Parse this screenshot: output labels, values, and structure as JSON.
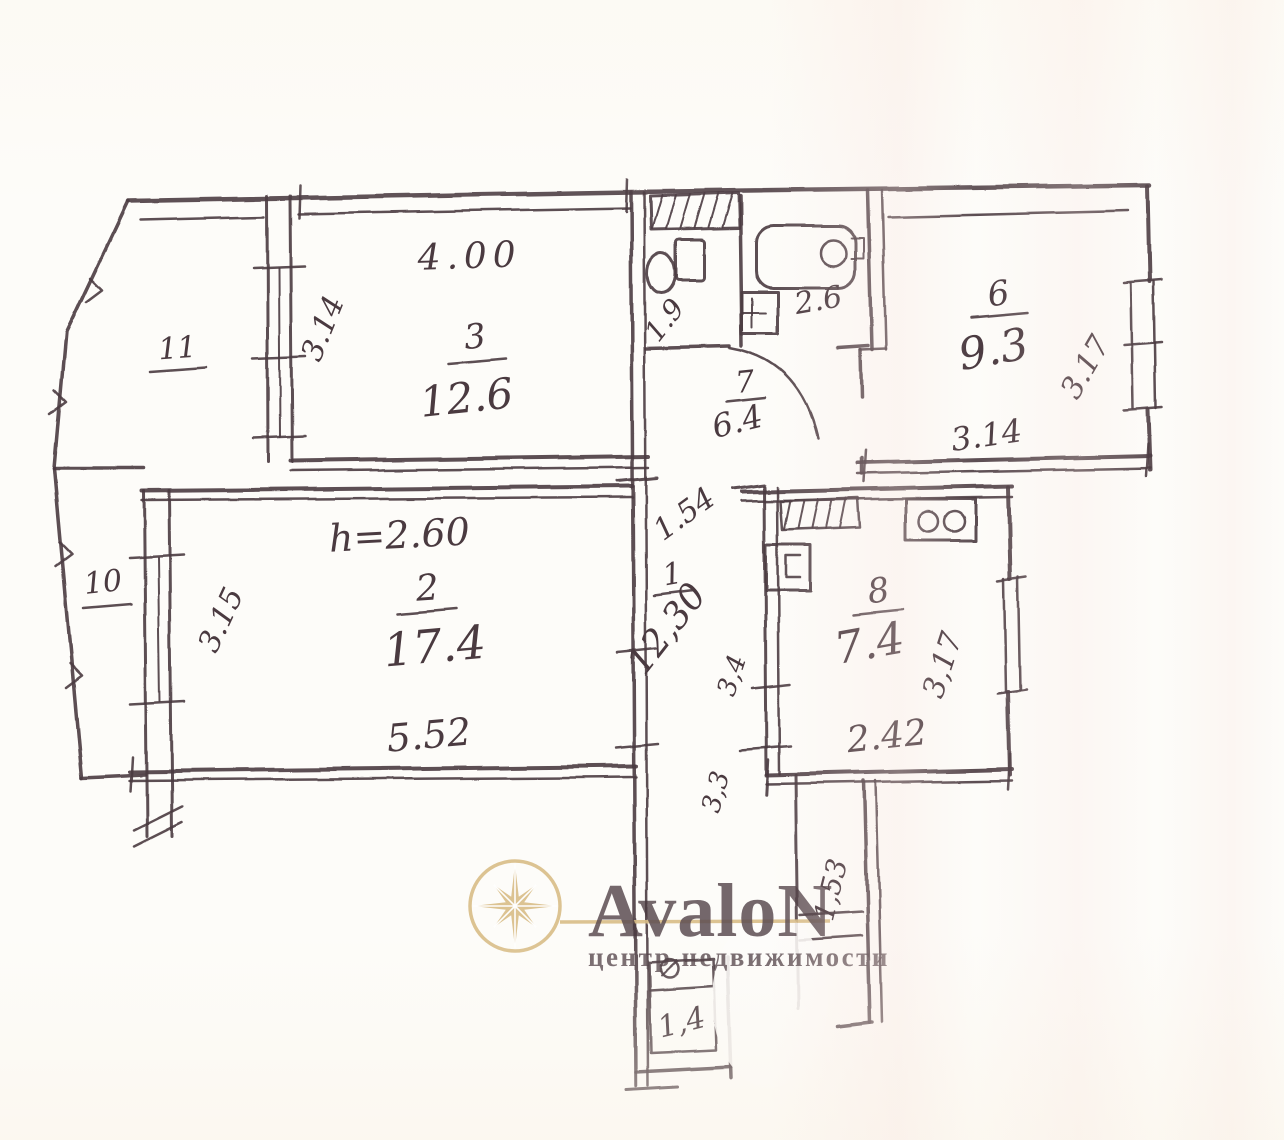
{
  "document": {
    "type": "hand-drawn apartment floor plan (scanned sketch)"
  },
  "plan": {
    "ink_color": "#4a3a40",
    "labels": {
      "r11": {
        "num": "11"
      },
      "r10": {
        "num": "10"
      },
      "r3": {
        "num": "3",
        "area": "12.6",
        "top": "4.00",
        "left": "3.14"
      },
      "wc": {
        "area": "1.9"
      },
      "bath": {
        "area": "2.6"
      },
      "r6": {
        "num": "6",
        "area": "9.3",
        "right": "3.17",
        "bottom": "3.14"
      },
      "hall": {
        "num": "7",
        "area": "6.4"
      },
      "r2": {
        "num": "2",
        "area": "17.4",
        "bottom": "5.52",
        "left": "3.15",
        "height": "h=2.60"
      },
      "cor": {
        "num": "1",
        "area": "12,30",
        "width": "1.54",
        "seg1": "3,4",
        "seg2": "3,3"
      },
      "kit": {
        "num": "8",
        "area": "7.4",
        "bottom": "2.42",
        "right": "3,17"
      },
      "entry": {
        "side": "1,53"
      },
      "loggia": {
        "area": "1,4"
      }
    }
  },
  "watermark": {
    "brand": "AvaloN",
    "tagline": "центр недвижимости",
    "brand_color": "#e15a68",
    "gold_color": "#d9bd87"
  }
}
